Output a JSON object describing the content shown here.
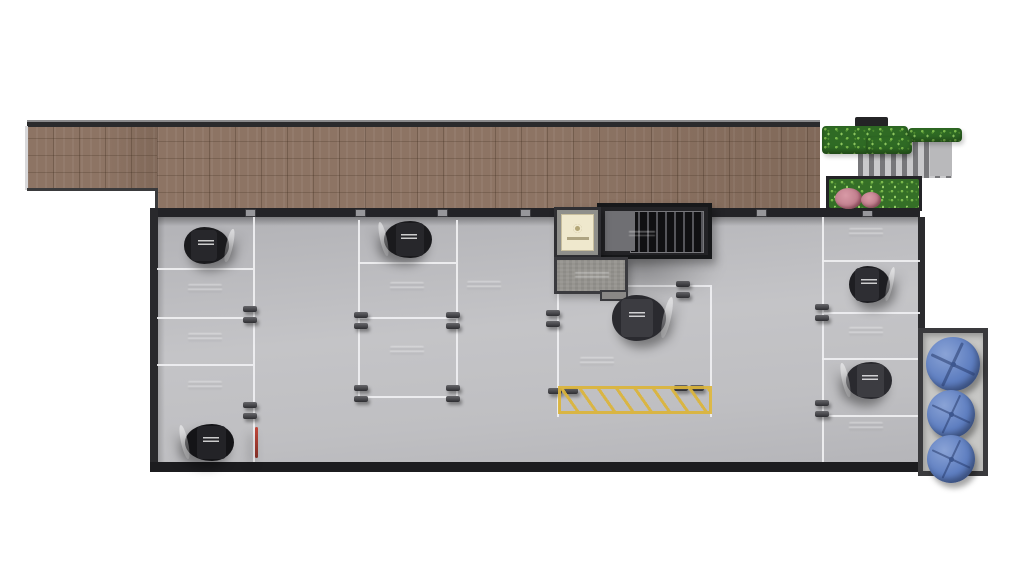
{
  "scene": {
    "description": "Top-down 3D architectural render of a residential building parking level floor plan",
    "background_color": "#ffffff",
    "text_note": "All stencil and bay markings in the source image are below legibility; reproduced as faint embossed marks only"
  },
  "palette": {
    "floor_gray": "#bfbfc2",
    "paving_brown": "#8d7464",
    "wall_dark": "#232327",
    "lane_line": "#f0f0f2",
    "hatch_yellow": "#dcb53a",
    "tank_blue": "#5e7ec0",
    "hedge_green": "#2f6a24",
    "flower_pink": "#c27f8e",
    "concrete": "#96948f",
    "stair_dark": "#232326",
    "elevator_cream": "#efe8cd"
  },
  "inventory": {
    "cars": 6,
    "water_tanks": 3,
    "marked_empty_bays": 10,
    "wheel_stop_pairs": 12,
    "no_parking_zones": 1,
    "stair_cores": 1,
    "elevators": 1,
    "planters": 4
  },
  "plan": {
    "lane_lines": [
      {
        "x": 253,
        "y": 217,
        "len": 245,
        "v": true
      },
      {
        "x": 822,
        "y": 217,
        "len": 245,
        "v": true
      },
      {
        "x": 157,
        "y": 268,
        "len": 96
      },
      {
        "x": 157,
        "y": 317,
        "len": 96
      },
      {
        "x": 157,
        "y": 364,
        "len": 96
      },
      {
        "x": 358,
        "y": 220,
        "len": 176,
        "v": true
      },
      {
        "x": 456,
        "y": 220,
        "len": 176,
        "v": true
      },
      {
        "x": 358,
        "y": 262,
        "len": 98
      },
      {
        "x": 358,
        "y": 317,
        "len": 98
      },
      {
        "x": 358,
        "y": 396,
        "len": 98
      },
      {
        "x": 557,
        "y": 285,
        "len": 153
      },
      {
        "x": 557,
        "y": 285,
        "len": 132,
        "v": true
      },
      {
        "x": 710,
        "y": 285,
        "len": 132,
        "v": true
      },
      {
        "x": 822,
        "y": 260,
        "len": 98
      },
      {
        "x": 822,
        "y": 312,
        "len": 98
      },
      {
        "x": 822,
        "y": 358,
        "len": 98
      },
      {
        "x": 822,
        "y": 415,
        "len": 98
      }
    ],
    "wall_clips": [
      245,
      355,
      437,
      520,
      756,
      862
    ],
    "wheel_stops": [
      {
        "x": 243,
        "y": 306,
        "o": "v"
      },
      {
        "x": 243,
        "y": 402,
        "o": "v"
      },
      {
        "x": 354,
        "y": 312,
        "o": "v"
      },
      {
        "x": 446,
        "y": 312,
        "o": "v"
      },
      {
        "x": 354,
        "y": 385,
        "o": "v"
      },
      {
        "x": 446,
        "y": 385,
        "o": "v"
      },
      {
        "x": 546,
        "y": 310,
        "o": "v"
      },
      {
        "x": 676,
        "y": 281,
        "o": "v"
      },
      {
        "x": 548,
        "y": 388,
        "o": "h"
      },
      {
        "x": 674,
        "y": 385,
        "o": "h"
      },
      {
        "x": 815,
        "y": 304,
        "o": "v"
      },
      {
        "x": 815,
        "y": 400,
        "o": "v"
      }
    ],
    "bay_labels": [
      {
        "x": 205,
        "y": 289
      },
      {
        "x": 205,
        "y": 338
      },
      {
        "x": 205,
        "y": 386
      },
      {
        "x": 407,
        "y": 287
      },
      {
        "x": 407,
        "y": 351
      },
      {
        "x": 484,
        "y": 286
      },
      {
        "x": 597,
        "y": 362
      },
      {
        "x": 866,
        "y": 233
      },
      {
        "x": 866,
        "y": 332
      },
      {
        "x": 866,
        "y": 427
      }
    ],
    "cars": [
      {
        "x": 160,
        "y": 224,
        "w": 94,
        "h": 43,
        "tone": "dark",
        "dir": "right",
        "tail": false
      },
      {
        "x": 357,
        "y": 217,
        "w": 100,
        "h": 45,
        "tone": "dark",
        "dir": "left",
        "tail": false
      },
      {
        "x": 584,
        "y": 291,
        "w": 113,
        "h": 54,
        "tone": "silver",
        "dir": "right",
        "tail": false
      },
      {
        "x": 827,
        "y": 262,
        "w": 86,
        "h": 45,
        "tone": "gray",
        "dir": "right",
        "tail": false
      },
      {
        "x": 820,
        "y": 358,
        "w": 96,
        "h": 45,
        "tone": "silver",
        "dir": "left",
        "tail": false
      },
      {
        "x": 157,
        "y": 420,
        "w": 103,
        "h": 45,
        "tone": "dark2",
        "dir": "left",
        "tail": true
      }
    ],
    "tanks": [
      {
        "cx": 953,
        "cy": 364,
        "r": 27
      },
      {
        "cx": 951,
        "cy": 414,
        "r": 24
      },
      {
        "cx": 951,
        "cy": 459,
        "r": 24
      }
    ]
  }
}
